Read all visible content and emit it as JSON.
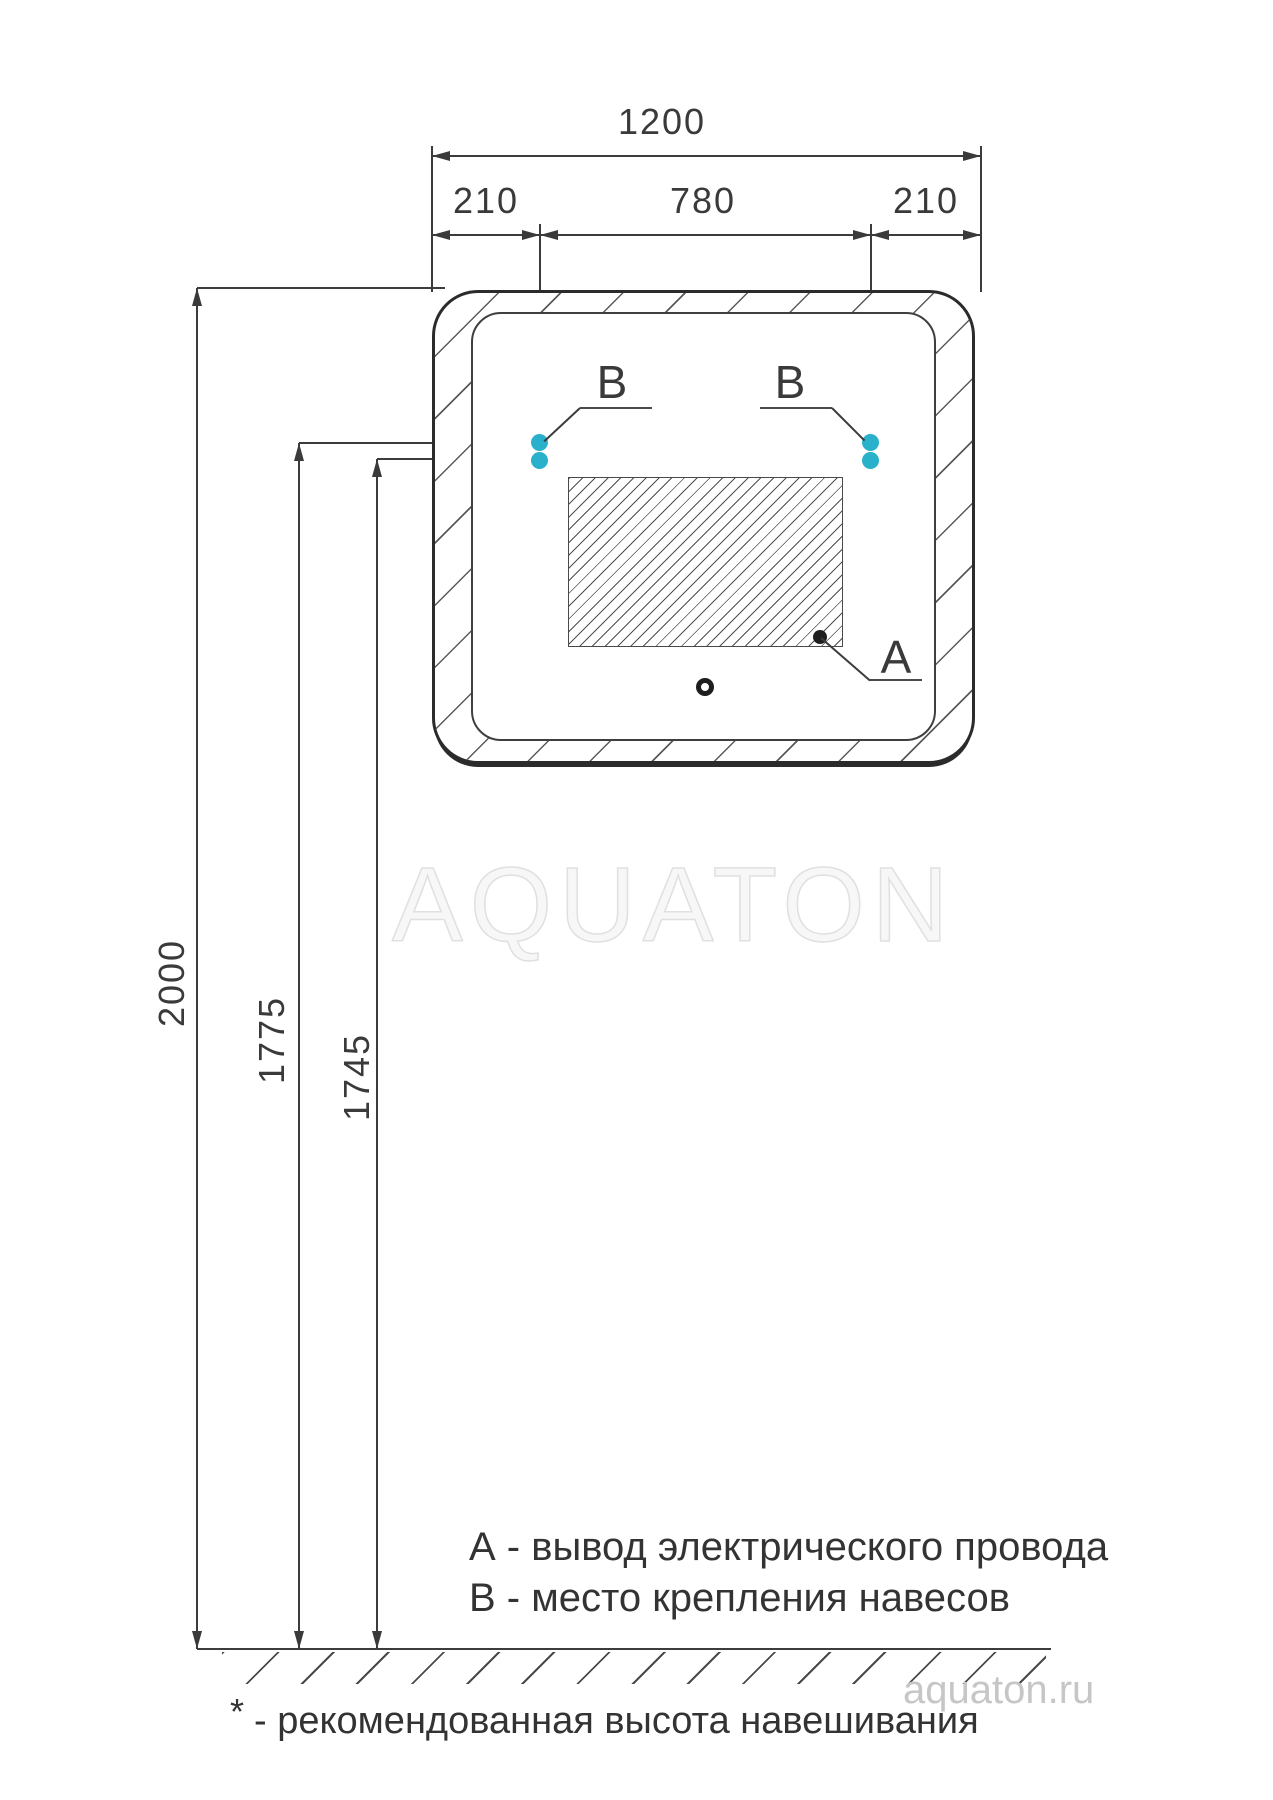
{
  "drawing": {
    "watermark": "AQUATON",
    "site": "aquaton.ru",
    "dims": {
      "width_total": "1200",
      "width_left": "210",
      "width_center": "780",
      "width_right": "210",
      "height_total": "2000",
      "height_upper_hole": "1775",
      "height_lower_hole": "1745"
    },
    "callouts": {
      "a": "A",
      "b_left": "B",
      "b_right": "B"
    },
    "legend": {
      "line_a": "А - вывод электрического провода",
      "line_b": "В - место крепления навесов"
    },
    "footnote_mark": "*",
    "footnote_text": "- рекомендованная высота навешивания",
    "colors": {
      "accent": "#29b0cb",
      "line": "#3c3c3c",
      "watermark": "#e0e0e0"
    }
  }
}
